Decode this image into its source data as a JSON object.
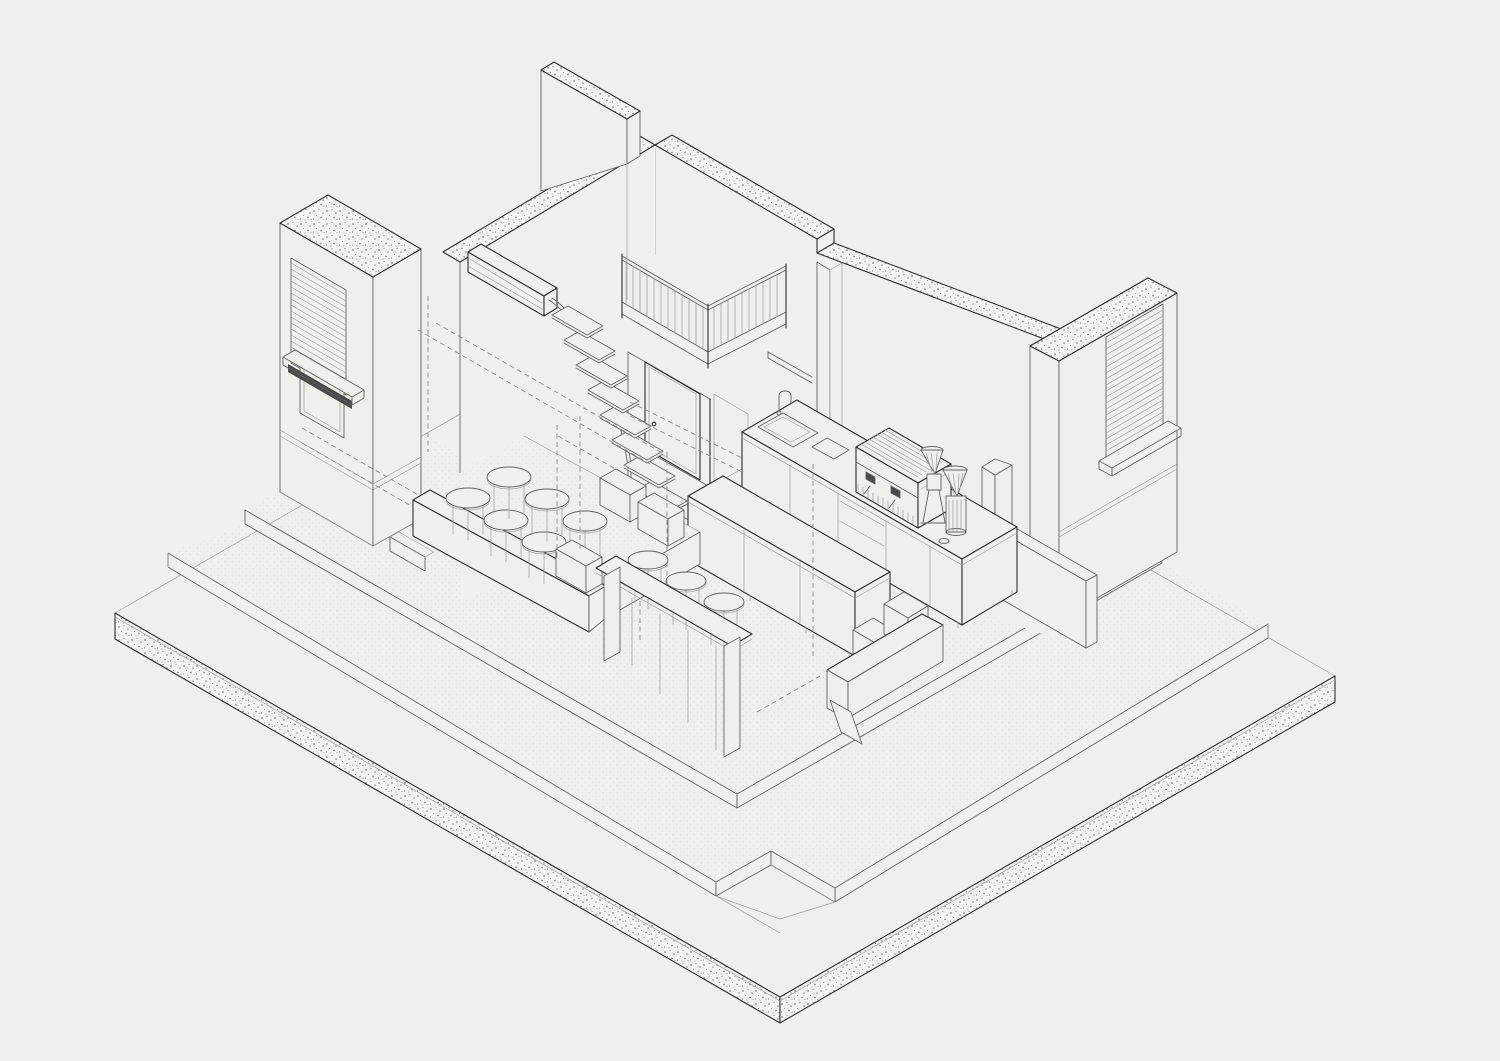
{
  "meta": {
    "type": "isometric-architectural-drawing",
    "description": "Axonometric cutaway line drawing of a small cafe: concrete base slab with raised terrace and room platform, cut walls with stippled tops, louvered facade windows, floating stair with curved handrail, mezzanine with slat balustrade, door, wall-mounted AC unit, barista counter with sink, espresso machine and two coffee grinders, island cabinet, long bar table with stools, raised seating deck with round stools and side tables, front bench and wall shelves."
  },
  "colors": {
    "bg": "#f0efeb",
    "ink-dark": "#2e2e2e",
    "ink-mid": "#636363",
    "ink-light": "#9c9c9c",
    "dash": "#8e8e8e",
    "stipple": "#8d8b84",
    "speckle": "#bdbbb2",
    "band": "#f4f3ef",
    "dark-fill": "#4a4a4a"
  },
  "scene": {
    "objects": [
      {
        "name": "base-slab",
        "kind": "concrete plinth with stippled cut edges"
      },
      {
        "name": "terrace-step",
        "kind": "raised outdoor step with corner recess"
      },
      {
        "name": "room-floor-platform",
        "kind": "raised interior floor, speckled finish"
      },
      {
        "name": "back-left-wall",
        "kind": "cut wall with stippled top band"
      },
      {
        "name": "back-right-wall",
        "kind": "cut wall with stippled top band and step"
      },
      {
        "name": "upper-mezzanine-wall",
        "kind": "tall cut wall section"
      },
      {
        "name": "left-facade",
        "kind": "exterior wall with louvered shutter window and sill"
      },
      {
        "name": "right-facade",
        "kind": "exterior wall with louvered shutter window and sill"
      },
      {
        "name": "mezzanine-balustrade",
        "kind": "corner railing with vertical slats"
      },
      {
        "name": "door",
        "kind": "single interior door with handle"
      },
      {
        "name": "column",
        "kind": "structural post at right wall"
      },
      {
        "name": "ac-unit",
        "kind": "wall-mounted air conditioner with conduit"
      },
      {
        "name": "floating-stairs",
        "kind": "nine cantilevered treads with curved handrail"
      },
      {
        "name": "barista-counter",
        "kind": "under-counter cabinets, drawers, sink and faucet"
      },
      {
        "name": "espresso-machine",
        "kind": "two-group machine with portafilters"
      },
      {
        "name": "coffee-grinders",
        "kind": "two hopper grinders"
      },
      {
        "name": "island-cabinet",
        "kind": "three-door sideboard on feet"
      },
      {
        "name": "long-bar-table",
        "kind": "panel-leg high table with three stools"
      },
      {
        "name": "seating-deck",
        "kind": "raised deck with parapet, six round stools, side tables"
      },
      {
        "name": "front-bench",
        "kind": "wedge-leg bench with two cube stools"
      },
      {
        "name": "wall-shelves",
        "kind": "box shelf and two small shelves with pole"
      },
      {
        "name": "hidden-lines",
        "kind": "dashed construction / hidden edges"
      }
    ]
  }
}
